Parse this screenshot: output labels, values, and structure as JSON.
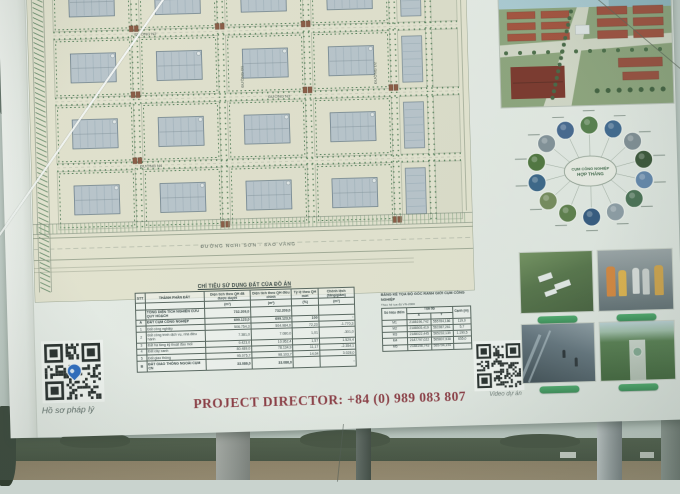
{
  "photo": {
    "caption_left": "Hồ sơ pháp lý",
    "caption_right": "Video dự án"
  },
  "board": {
    "hotline": "PROJECT DIRECTOR: +84 (0) 989 083 807",
    "map": {
      "street_labels": [
        "ĐƯỜNG N2",
        "ĐƯỜNG N3",
        "ĐƯỜNG N4",
        "ĐƯỜNG D1",
        "ĐƯỜNG D2"
      ],
      "main_road_label": "ĐƯỜNG NGHI SƠN - SAO VÀNG"
    },
    "land_use_table": {
      "title": "CHỈ TIÊU SỬ DỤNG ĐẤT CỦA ĐỒ ÁN",
      "columns": [
        "STT",
        "THÀNH PHẦN ĐẤT",
        "Diện tích theo QH đã được duyệt",
        "Diện tích theo QH điều chỉnh",
        "Tỷ lệ theo QH mới",
        "Chênh lệch (tăng/giảm)"
      ],
      "units": [
        "",
        "",
        "(m²)",
        "(m²)",
        "(%)",
        "(m²)"
      ],
      "rows": [
        [
          "",
          "TỔNG DIỆN TÍCH NGHIÊN CỨU QUY HOẠCH",
          "732.209,0",
          "732.209,0",
          "",
          ""
        ],
        [
          "A",
          "ĐẤT CỤM CÔNG NGHIỆP",
          "699.123,0",
          "699.123,0",
          "100",
          "-"
        ],
        [
          "1",
          "Đất công nghiệp",
          "506.754,3",
          "504.984,0",
          "72,23",
          "-1.770,3"
        ],
        [
          "2",
          "Đất công trình dịch vụ, nhà điều hành",
          "7.381,0",
          "7.080,0",
          "1,01",
          "-301,0"
        ],
        [
          "3",
          "Đất hạ tầng kỹ thuật đầu mối",
          "9.423,0",
          "10.952,4",
          "1,57",
          "1.529,4"
        ],
        [
          "4",
          "Đất cây xanh",
          "80.489,0",
          "78.134,9",
          "11,17",
          "-2.354,1"
        ],
        [
          "5",
          "Đất giao thông",
          "95.075,7",
          "98.103,7",
          "14,04",
          "3.028,0"
        ],
        [
          "B",
          "ĐẤT GIAO THÔNG NGOÀI CỤM CN",
          "33.086,0",
          "33.086,0",
          "",
          "-"
        ]
      ]
    },
    "coordinate_table": {
      "title": "BẢNG KÊ TỌA ĐỘ GÓC RANH GIỚI CỤM CÔNG NGHIỆP",
      "subtitle": "Theo hệ tọa độ VN-2000",
      "col_point": "Số hiệu điểm",
      "col_group": "Tọa độ",
      "col_x": "X",
      "col_y": "Y",
      "col_edge": "Cạnh (m)",
      "rows": [
        [
          "M1",
          "2188196,742",
          "565784,186",
          "119,0"
        ],
        [
          "M2",
          "2188505,419",
          "561987,261",
          "5,7"
        ],
        [
          "M3",
          "2188022,445",
          "565232,139",
          "1.190,5"
        ],
        [
          "M4",
          "2187797,022",
          "565807,538",
          "655,0"
        ],
        [
          "M5",
          "2188198,743",
          "565794,194",
          ""
        ]
      ]
    },
    "hub_diagram": {
      "center_line1": "CỤM CÔNG NGHIỆP",
      "center_line2": "HỢP THẮNG",
      "satellite_count": 14,
      "palette": [
        "#4c7a3f",
        "#33618f",
        "#7b8a92",
        "#2f4d2a",
        "#5b82ae",
        "#3f6b49",
        "#8a9aa4",
        "#27507c",
        "#54793e",
        "#6f8750",
        "#2e5e86",
        "#45702f",
        "#7d8d96",
        "#3a5f8f"
      ]
    },
    "colors": {
      "accent_green": "#3aa05a",
      "hotline_red": "#8e2f38",
      "qr_pin_blue": "#1d66c9"
    }
  }
}
